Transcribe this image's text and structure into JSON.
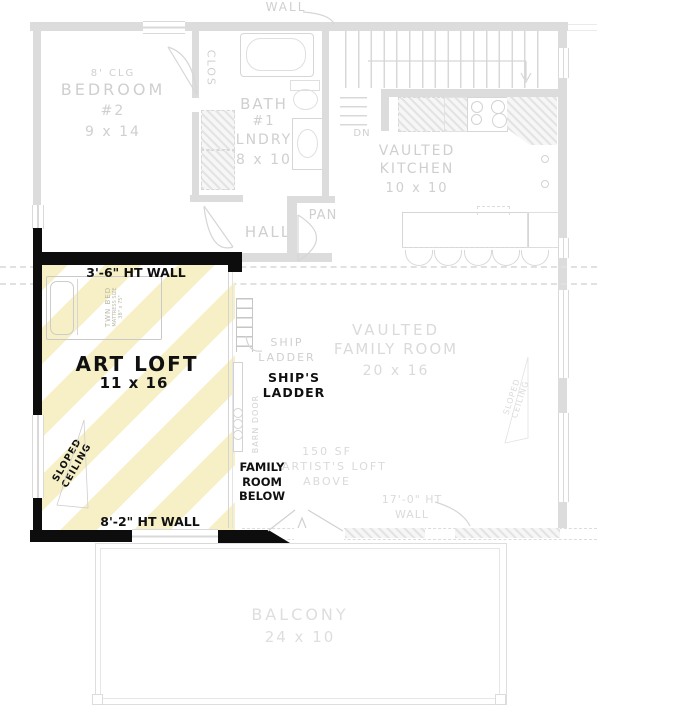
{
  "colors": {
    "highlight_yellow": "#f7f0c6",
    "wall_black": "#0d0d0d",
    "plan_gray": "#d6d6d6",
    "text_gray": "#cfcfcf"
  },
  "plan": {
    "top": {
      "wall_label": "WALL"
    },
    "bedroom2": {
      "ceiling": "8' CLG",
      "name": "BEDROOM",
      "number": "#2",
      "dims": "9 x 14"
    },
    "closet": {
      "label": "CLOS"
    },
    "bath": {
      "name": "BATH",
      "number": "#1",
      "laundry": "LNDRY",
      "dims": "8 x 10"
    },
    "hall": {
      "label": "HALL"
    },
    "pantry": {
      "label": "PAN"
    },
    "stairs": {
      "down": "DN"
    },
    "kitchen": {
      "line1": "VAULTED",
      "line2": "KITCHEN",
      "dims": "10 x 10"
    },
    "art_loft": {
      "top_wall": "3'-6\" HT WALL",
      "name": "ART LOFT",
      "dims": "11 x 16",
      "sloped1": "SLOPED",
      "sloped2": "CEILING",
      "bottom_wall": "8'-2\" HT WALL",
      "bed1": "TWN BED",
      "bed2": "MATTRESS SIZE",
      "bed3": "38\" x 75\"",
      "barn_door": "BARN DOOR",
      "below1": "FAMILY",
      "below2": "ROOM",
      "below3": "BELOW",
      "ladder1": "SHIP'S",
      "ladder2": "LADDER"
    },
    "family_room": {
      "ladder_note1": "SHIP",
      "ladder_note2": "LADDER",
      "line1": "VAULTED",
      "line2": "FAMILY ROOM",
      "dims": "20 x 16",
      "note1": "150 SF",
      "note2": "ARTIST'S LOFT",
      "note3": "ABOVE",
      "ht1": "17'-0\" HT",
      "ht2": "WALL",
      "sloped1": "SLOPED",
      "sloped2": "CEILING"
    },
    "balcony": {
      "name": "BALCONY",
      "dims": "24 x 10"
    }
  }
}
